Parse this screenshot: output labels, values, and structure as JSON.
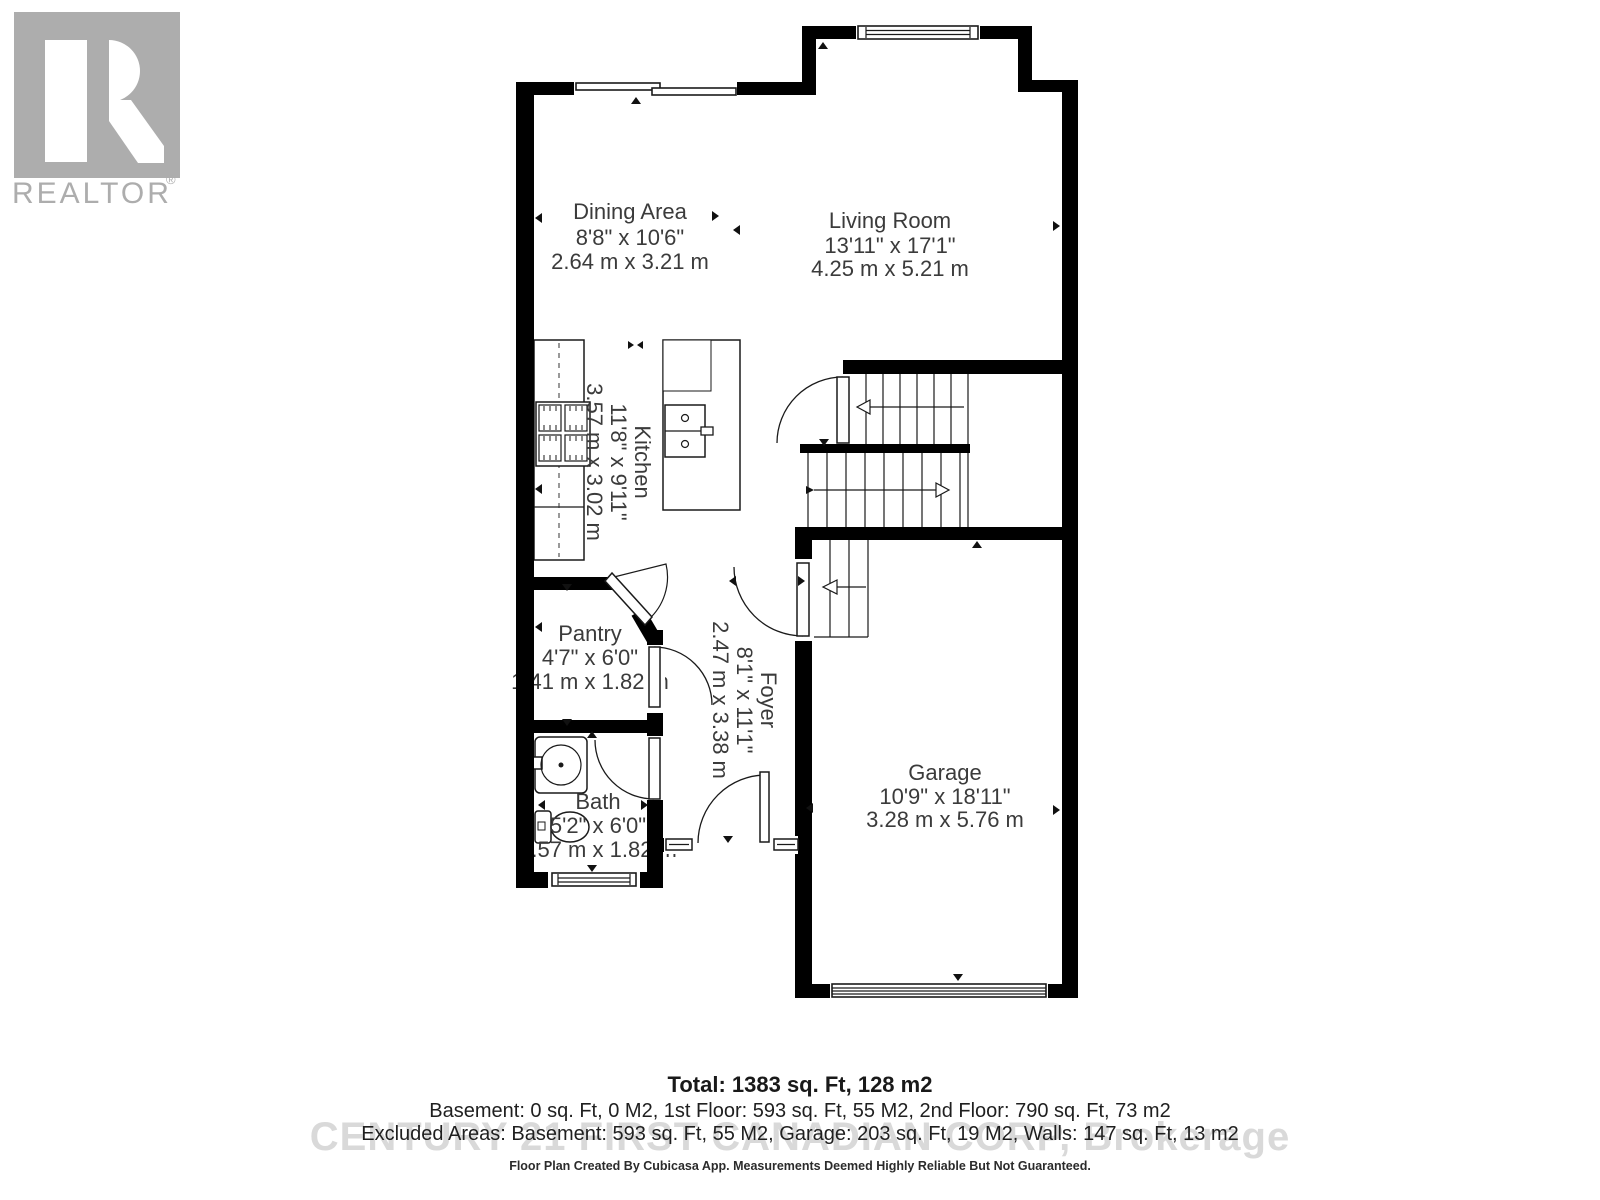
{
  "branding": {
    "logo_text": "REALTOR",
    "registered_mark": "®",
    "watermark": "CENTURY 21 FIRST CANADIAN CORP, Brokerage"
  },
  "rooms": [
    {
      "name": "Dining Area",
      "imperial": "8'8\" x 10'6\"",
      "metric": "2.64 m x 3.21 m"
    },
    {
      "name": "Living Room",
      "imperial": "13'11\" x 17'1\"",
      "metric": "4.25 m x 5.21 m"
    },
    {
      "name": "Kitchen",
      "imperial": "11'8\" x 9'11\"",
      "metric": "3.57 m x 3.02 m"
    },
    {
      "name": "Pantry",
      "imperial": "4'7\" x 6'0\"",
      "metric": "1.41 m x 1.82 m"
    },
    {
      "name": "Foyer",
      "imperial": "8'1\" x 11'1\"",
      "metric": "2.47 m x 3.38 m"
    },
    {
      "name": "Bath",
      "imperial": "5'2\" x 6'0\"",
      "metric": "1.57 m x 1.82 m"
    },
    {
      "name": "Garage",
      "imperial": "10'9\" x 18'11\"",
      "metric": "3.28 m x 5.76 m"
    }
  ],
  "summary": {
    "total": "Total: 1383 sq. Ft, 128 m2",
    "floors": "Basement: 0 sq. Ft, 0 M2, 1st Floor: 593 sq. Ft, 55 M2, 2nd Floor: 790 sq. Ft, 73 m2",
    "excluded": "Excluded Areas: Basement: 593 sq. Ft, 55 M2, Garage: 203 sq. Ft, 19 M2, Walls: 147 sq. Ft, 13 m2",
    "disclaimer": "Floor Plan Created By Cubicasa App. Measurements Deemed Highly Reliable But Not Guaranteed."
  }
}
